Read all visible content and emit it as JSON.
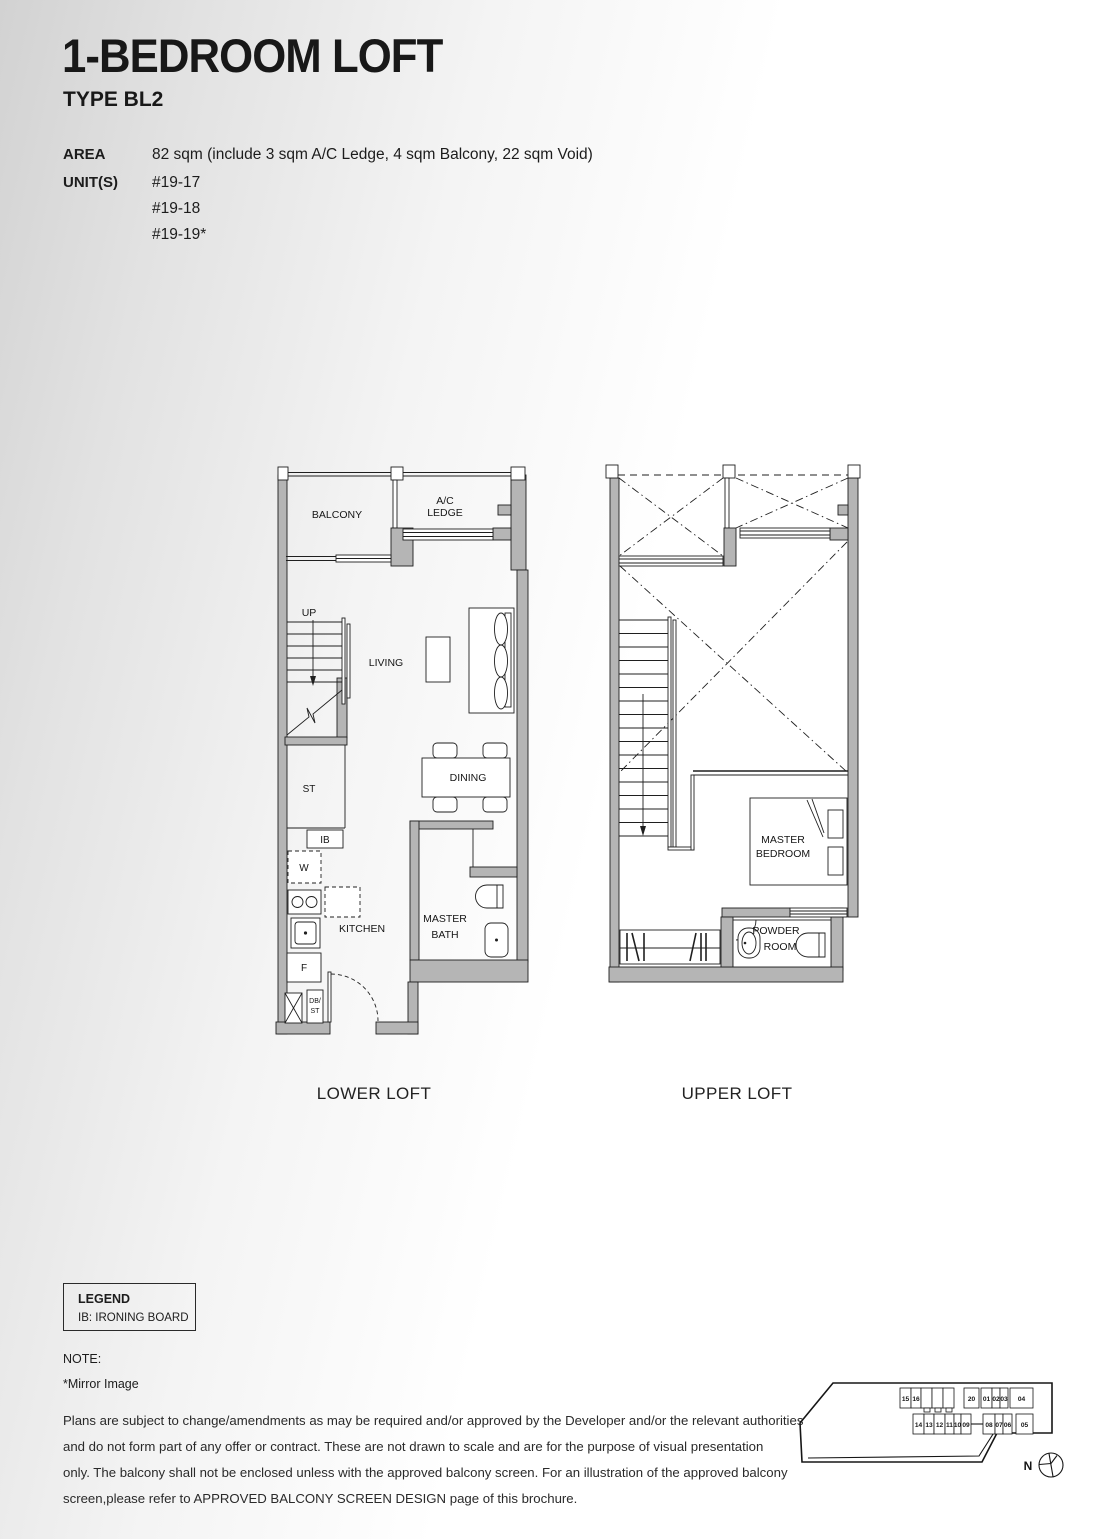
{
  "header": {
    "title": "1-BEDROOM LOFT",
    "type": "TYPE BL2",
    "area_label": "AREA",
    "area_value": "82 sqm (include 3 sqm A/C Ledge, 4 sqm Balcony, 22 sqm Void)",
    "units_label": "UNIT(S)",
    "unit_1": "#19-17",
    "unit_2": "#19-18",
    "unit_3": "#19-19*"
  },
  "lower_plan": {
    "caption": "LOWER LOFT",
    "balcony": "BALCONY",
    "ac_line1": "A/C",
    "ac_line2": "LEDGE",
    "up": "UP",
    "living": "LIVING",
    "dining": "DINING",
    "st": "ST",
    "ib": "IB",
    "w": "W",
    "kitchen": "KITCHEN",
    "f": "F",
    "db_line1": "DB/",
    "db_line2": "ST",
    "bath_line1": "MASTER",
    "bath_line2": "BATH"
  },
  "upper_plan": {
    "caption": "UPPER LOFT",
    "bedroom_line1": "MASTER",
    "bedroom_line2": "BEDROOM",
    "powder_line1": "POWDER",
    "powder_line2": "ROOM"
  },
  "legend": {
    "title": "LEGEND",
    "item_1": "IB: IRONING BOARD"
  },
  "note": {
    "title": "NOTE:",
    "line_1": "*Mirror Image"
  },
  "disclaimer": "Plans are subject to change/amendments as may be required and/or approved by the Developer and/or the relevant authorities\nand do not form part of any offer or contract. These are not drawn to scale and are for the purpose of visual presentation\nonly. The balcony shall not be enclosed unless with the approved balcony screen. For an illustration of the approved balcony\nscreen,please refer to APPROVED BALCONY SCREEN DESIGN page of this brochure.",
  "keyplan": {
    "north": "N",
    "highlight_color": "#1e4f60",
    "top_units": [
      "15",
      "16",
      "17",
      "18",
      "19",
      "20",
      "01",
      "02",
      "03",
      "04"
    ],
    "bottom_units": [
      "14",
      "13",
      "12",
      "11",
      "10",
      "09",
      "08",
      "07",
      "06",
      "05"
    ]
  }
}
